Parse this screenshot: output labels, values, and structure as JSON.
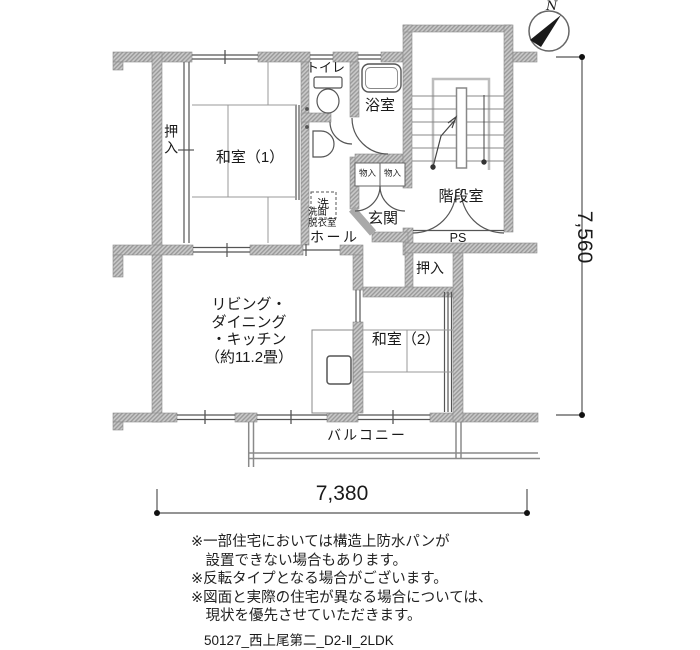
{
  "compass": {
    "north_label": "N"
  },
  "dimensions": {
    "horizontal": "7,380",
    "vertical": "7,560"
  },
  "rooms": {
    "washitsu1": {
      "label": "和室（1）"
    },
    "oshiire1": {
      "label": "押入"
    },
    "toilet": {
      "label": "トイレ"
    },
    "bath": {
      "label": "浴室"
    },
    "staircase": {
      "label": "階段室"
    },
    "storage1": {
      "label": "物入"
    },
    "storage2": {
      "label": "物入"
    },
    "genkan": {
      "label": "玄関"
    },
    "washer": {
      "label": "洗"
    },
    "washroom": {
      "line1": "洗面",
      "line2": "脱衣室"
    },
    "hall": {
      "label": "ホール"
    },
    "ps": {
      "label": "PS"
    },
    "oshiire2": {
      "label": "押入"
    },
    "ldk": {
      "line1": "リビング・",
      "line2": "ダイニング",
      "line3": "・キッチン",
      "line4": "（約11.2畳）"
    },
    "washitsu2": {
      "label": "和室（2）"
    },
    "balcony": {
      "label": "バルコニー"
    }
  },
  "notes": [
    "※一部住宅においては構造上防水パンが",
    "　設置できない場合もあります。",
    "※反転タイプとなる場合がございます。",
    "※図面と実際の住宅が異なる場合については、",
    "　現状を優先させていただきます。"
  ],
  "footer": "50127_西上尾第二_D2-Ⅱ_2LDK",
  "colors": {
    "wall": "#a2a2a2",
    "line": "#555555",
    "text": "#1a1a1a"
  }
}
